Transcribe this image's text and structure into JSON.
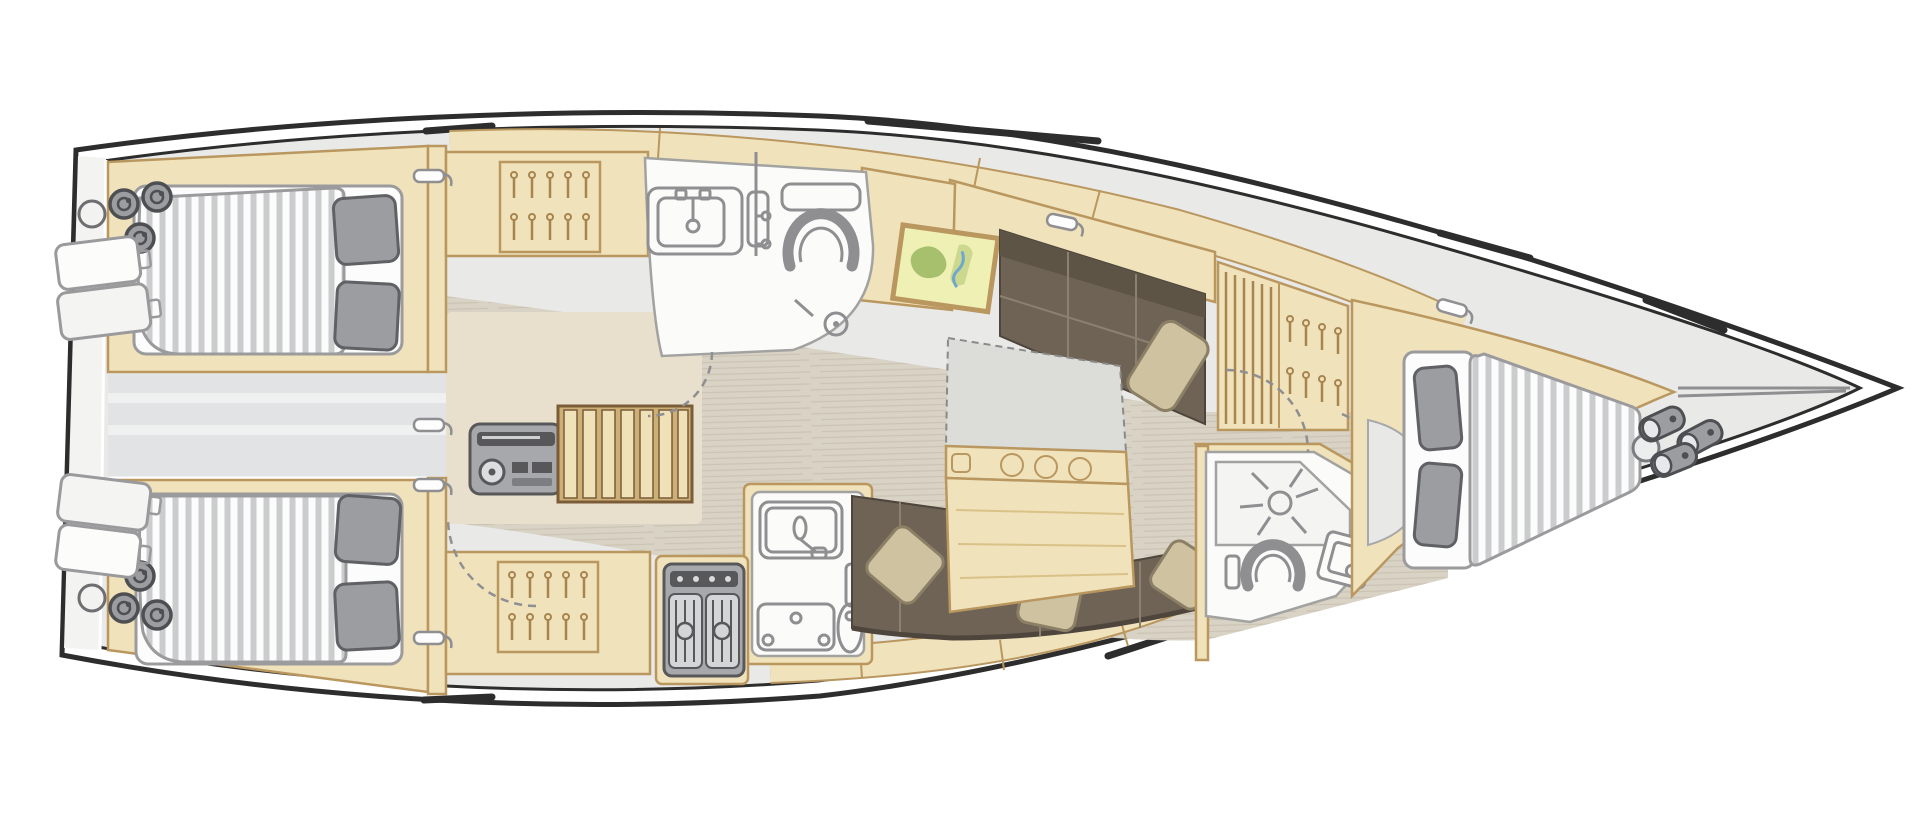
{
  "plan": {
    "vessel": "sailing-yacht-monohull",
    "view": "interior-deck-plan-top-view",
    "bow_direction": "right",
    "stern_direction": "left",
    "areas": [
      {
        "id": "cockpit",
        "label": "cockpit / transom",
        "fixtures": [
          "winch-cluster-top",
          "winch-cluster-bottom",
          "helm-seat-top",
          "helm-seat-bottom"
        ]
      },
      {
        "id": "aft-cabin-top",
        "label": "aft double cabin (top)",
        "fixtures": [
          "double-berth",
          "striped-mattress",
          "two-gray-pillows",
          "hanging-locker",
          "door-latch"
        ]
      },
      {
        "id": "aft-cabin-bottom",
        "label": "aft double cabin (bottom)",
        "fixtures": [
          "double-berth",
          "striped-mattress",
          "two-gray-pillows",
          "hanging-locker",
          "door-latch"
        ]
      },
      {
        "id": "engine-compartment",
        "label": "engine compartment",
        "fixtures": [
          "engine-unit"
        ]
      },
      {
        "id": "companionway",
        "label": "companionway",
        "fixtures": [
          "companionway-stairs"
        ]
      },
      {
        "id": "head-aft",
        "label": "aft head / wet room",
        "fixtures": [
          "washbasin",
          "toilet",
          "shower-drain",
          "wall-hooks",
          "door-swing"
        ]
      },
      {
        "id": "nav-station",
        "label": "chart table",
        "fixtures": [
          "sea-chart"
        ]
      },
      {
        "id": "saloon",
        "label": "saloon",
        "fixtures": [
          "straight-settee",
          "l-shaped-settee",
          "folding-table",
          "bottle-holder-3-rings",
          "scatter-cushions"
        ]
      },
      {
        "id": "galley",
        "label": "galley",
        "fixtures": [
          "two-burner-stove",
          "sink-with-faucet",
          "top-load-fridge",
          "oval-basin",
          "chopping-board"
        ]
      },
      {
        "id": "head-forward",
        "label": "forward head / shower",
        "fixtures": [
          "corner-shower",
          "toilet",
          "corner-washbasin",
          "toilet-roll-holder",
          "door-swing"
        ]
      },
      {
        "id": "forward-cabin",
        "label": "forward V-berth cabin",
        "fixtures": [
          "v-berth",
          "striped-mattress",
          "two-gray-pillows",
          "hanging-locker",
          "louvered-locker",
          "corner-shelf",
          "door-latch"
        ]
      },
      {
        "id": "bow-locker",
        "label": "bow / anchor locker",
        "fixtures": [
          "mooring-line-rolls"
        ]
      }
    ],
    "counts": {
      "berths": 3,
      "heads": 2,
      "winches": 6,
      "helm_seats": 2,
      "saloon_cushions": 4,
      "mooring_rolls": 3,
      "stove_burners": 2
    }
  },
  "colors": {
    "background": "#ffffff",
    "hull_line": "#2d2d2d",
    "deck": "#e9e9e8",
    "transom": "#f3f3f2",
    "floor": "#d9d3c6",
    "floor_grain": "#bdb4a0",
    "floor_light": "#e8e0cd",
    "wood": "#f0e2bb",
    "wood_dark": "#b9975f",
    "wood_slat": "#a8854f",
    "white_room": "#fbfbfa",
    "room_edge": "#a2a2a0",
    "fixture": "#8f8f92",
    "mattress": "#fcfcfc",
    "mattress_stripe": "#cbccce",
    "mattress_edge": "#9b9b9e",
    "pillow": "#9c9da0",
    "pillow_edge": "#606165",
    "settee": "#6e6355",
    "settee_dark": "#5d5446",
    "settee_edge": "#4e463c",
    "settee_seam": "#8c8171",
    "cushion": "#cfc2a0",
    "cushion_edge": "#8b8066",
    "map_bg": "#eef0b4",
    "map_land": "#a6c06e",
    "map_land2": "#ccd88d",
    "map_water": "#6fa8cc",
    "metal": "#a7a8ab",
    "metal_dark": "#58585b",
    "winch": "#9c9da0",
    "winch_dark": "#4e4f52",
    "stairs_a": "#f0e2b8",
    "stairs_b": "#cdb076",
    "stairs_edge": "#7a5c38"
  }
}
